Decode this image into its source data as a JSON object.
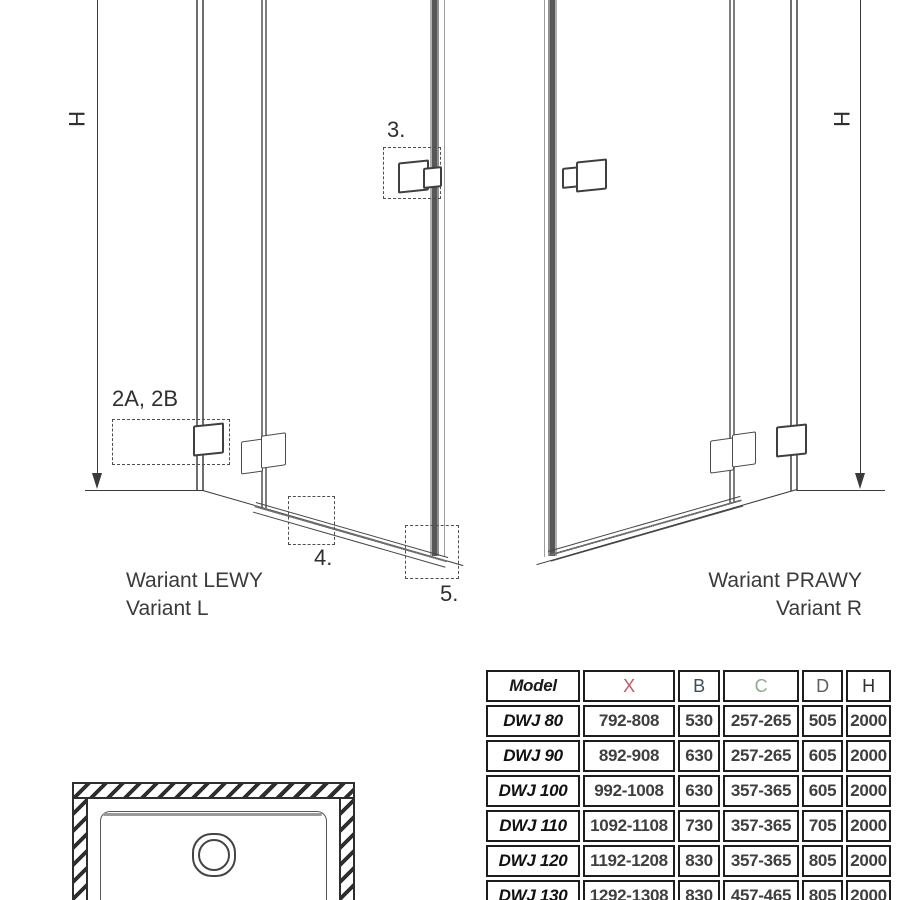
{
  "left_diagram": {
    "caption_line1": "Wariant LEWY",
    "caption_line2": "Variant L",
    "height_label": "H",
    "callout_hinges": "2A, 2B",
    "callout_handle": "3.",
    "callout_threshold": "4.",
    "callout_bottom_guide": "5."
  },
  "right_diagram": {
    "caption_line1": "Wariant PRAWY",
    "caption_line2": "Variant R",
    "height_label": "H"
  },
  "table": {
    "headers": [
      "Model",
      "X",
      "B",
      "C",
      "D",
      "H"
    ],
    "header_colors": {
      "Model": "#1a1a1a",
      "X": "#c05a68",
      "B": "#3f4d5a",
      "C": "#8aae8a",
      "D": "#5a5f63",
      "H": "#2f3337"
    },
    "rows": [
      {
        "model": "DWJ 80",
        "x": "792-808",
        "b": "530",
        "c": "257-265",
        "d": "505",
        "h": "2000"
      },
      {
        "model": "DWJ 90",
        "x": "892-908",
        "b": "630",
        "c": "257-265",
        "d": "605",
        "h": "2000"
      },
      {
        "model": "DWJ 100",
        "x": "992-1008",
        "b": "630",
        "c": "357-365",
        "d": "605",
        "h": "2000"
      },
      {
        "model": "DWJ 110",
        "x": "1092-1108",
        "b": "730",
        "c": "357-365",
        "d": "705",
        "h": "2000"
      },
      {
        "model": "DWJ 120",
        "x": "1192-1208",
        "b": "830",
        "c": "357-365",
        "d": "805",
        "h": "2000"
      },
      {
        "model": "DWJ 130",
        "x": "1292-1308",
        "b": "830",
        "c": "457-465",
        "d": "805",
        "h": "2000"
      }
    ]
  },
  "line_color": "#3a3a3a"
}
